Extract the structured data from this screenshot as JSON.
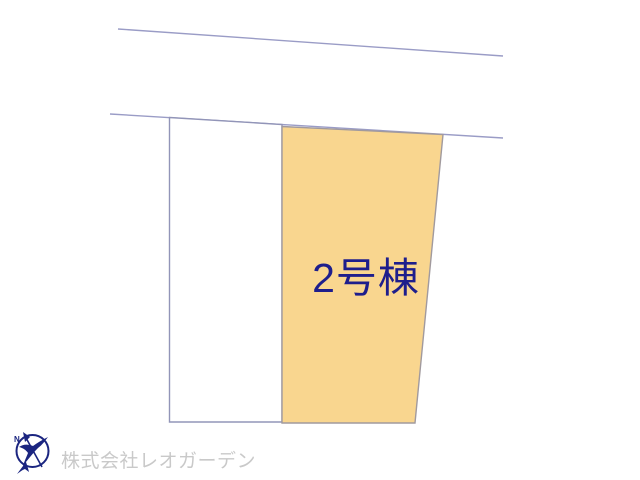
{
  "site_plan": {
    "lot_label": "2号棟",
    "lot_fill_color": "#f9d68f",
    "lot_label_color": "#1e1e8c",
    "road_line_color": "#9a9cc6",
    "parcel_border_color": "#9295b8",
    "lot_border_color": "#a19a9e"
  },
  "branding": {
    "logo_color": "#1b2580",
    "logo_north_label": "N",
    "company_name": "株式会社レオガーデン",
    "company_name_color": "#c9c9c9"
  }
}
